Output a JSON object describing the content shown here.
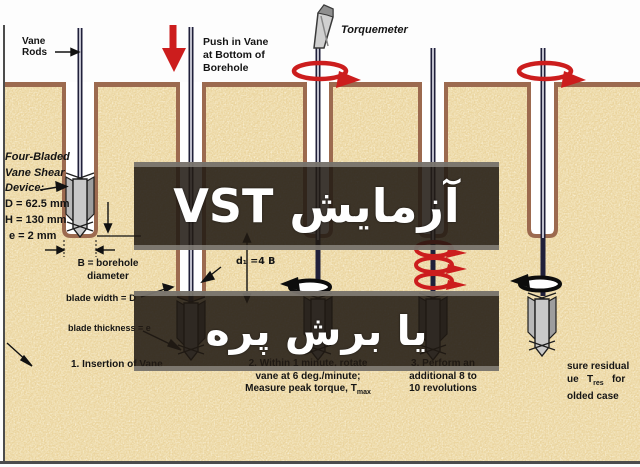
{
  "banners": {
    "top": {
      "text": "آزمایش VST"
    },
    "bottom": {
      "text": "یا برش پره"
    }
  },
  "labels": {
    "vane_rods": [
      "Vane",
      "Rods"
    ],
    "push_in_vane": [
      "Push in Vane",
      "at Bottom of",
      "Borehole"
    ],
    "torquemeter": "Torquemeter",
    "device_name": [
      "Four-Bladed",
      "Vane Shear",
      "Device:"
    ],
    "device_dims": [
      "D = 62.5 mm",
      "H = 130 mm",
      "e = 2 mm"
    ],
    "borehole_diameter": [
      "B = borehole",
      "diameter"
    ],
    "blade_width": "blade width = D",
    "blade_thickness": "blade thickness = e",
    "d1": "d₁ =4 B"
  },
  "steps": {
    "step1": "1.  Insertion of Vane",
    "step2_lines": [
      "2.  Within 1 minute, rotate",
      "vane at 6 deg./minute;"
    ],
    "step2_t": "Measure peak torque, T",
    "step2_sub": "max",
    "step3_lines": [
      "3.  Perform an",
      "additional 8 to",
      "10 revolutions"
    ],
    "step4": {
      "line1": "sure residual",
      "t": "ue   T",
      "sub": "res",
      "end": "   for",
      "line3": "olded case"
    }
  },
  "colors": {
    "soil": "#ead49e",
    "borehole_rim": "#9c6a4f",
    "accent_red": "#cc1d1d",
    "rod": "#20203a",
    "banner_background": "#211a14",
    "banner_text": "#ffffff"
  }
}
